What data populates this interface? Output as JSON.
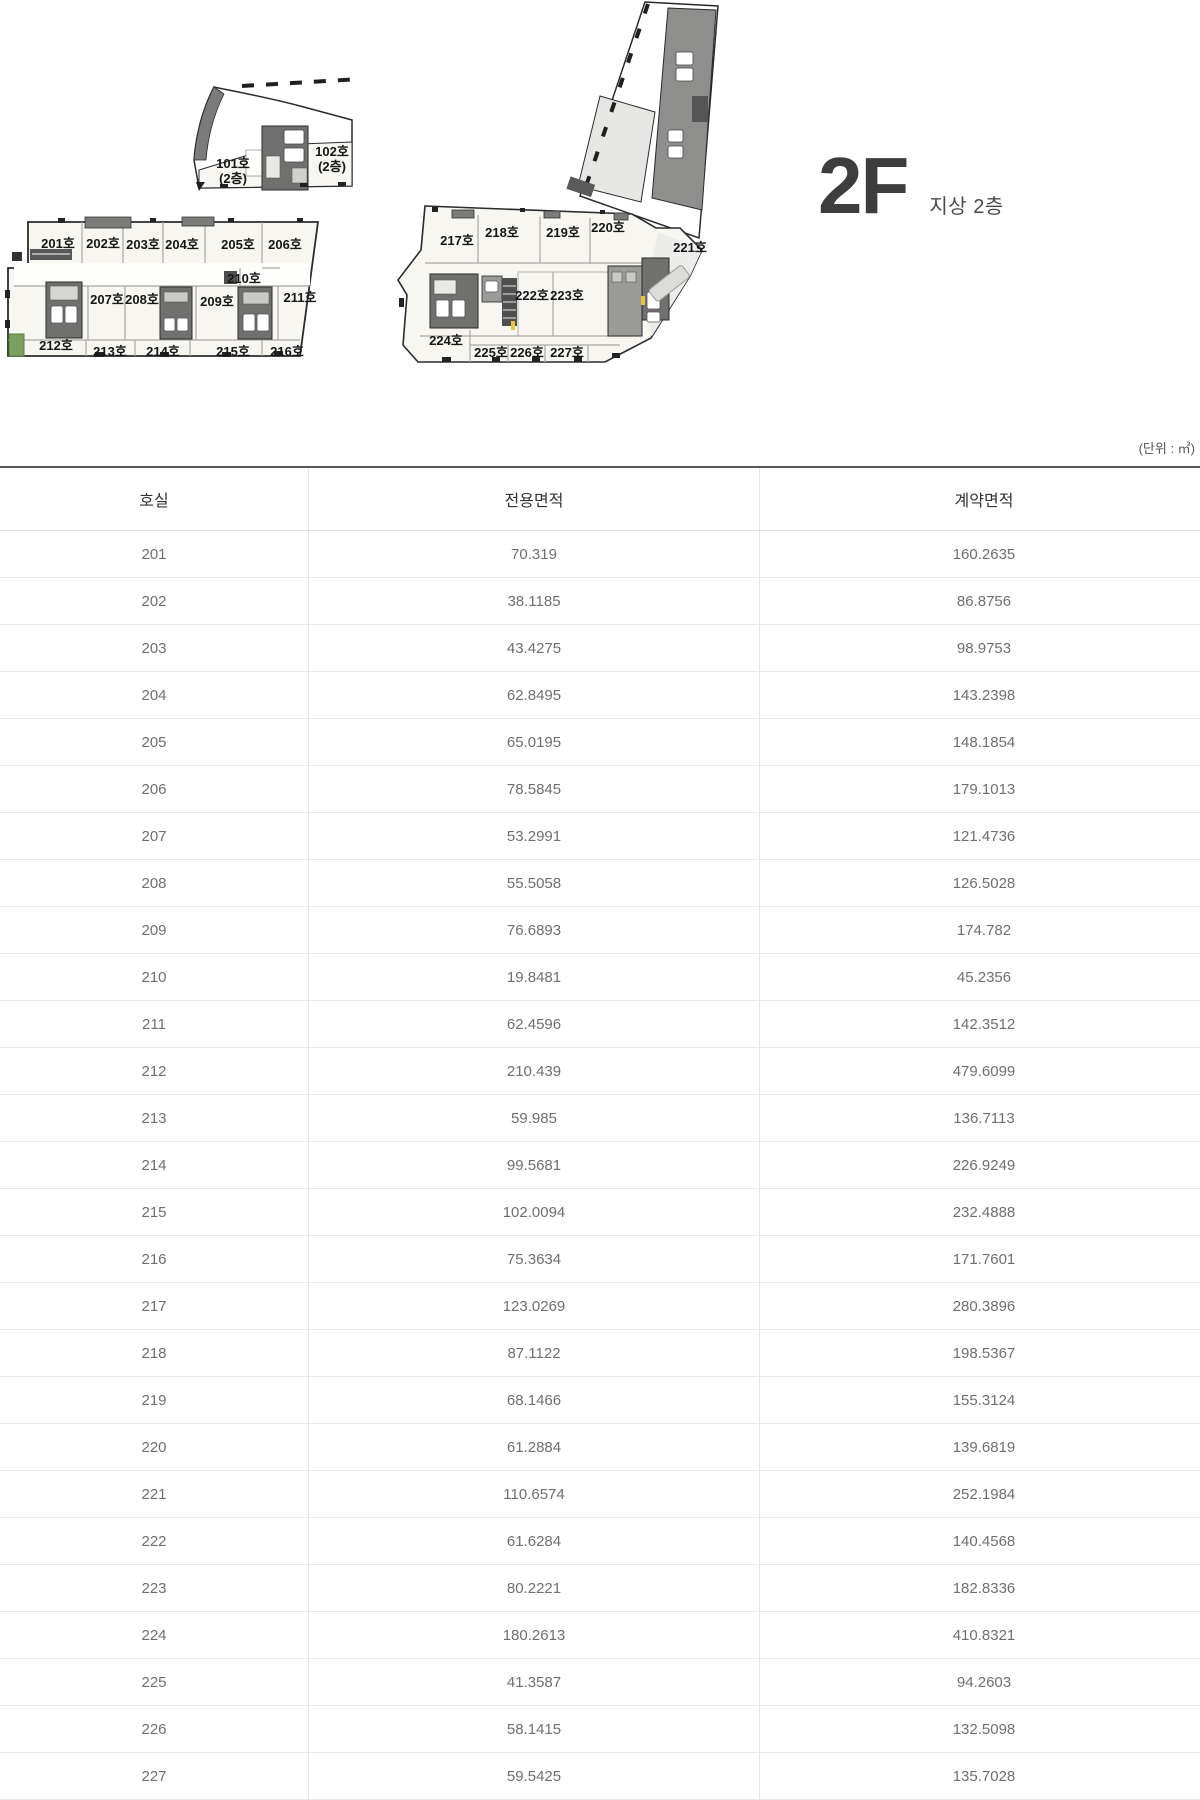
{
  "title": {
    "floor": "2F",
    "floor_desc": "지상 2층"
  },
  "unit_note": "(단위 : ㎡)",
  "plans": {
    "small_wing": {
      "labels": [
        {
          "text": "101호",
          "x": 233,
          "y": 168
        },
        {
          "text": "(2층)",
          "x": 233,
          "y": 183
        },
        {
          "text": "102호",
          "x": 332,
          "y": 156
        },
        {
          "text": "(2층)",
          "x": 332,
          "y": 171
        }
      ]
    },
    "left_wing": {
      "labels": [
        {
          "text": "201호",
          "x": 58,
          "y": 248
        },
        {
          "text": "202호",
          "x": 103,
          "y": 248
        },
        {
          "text": "203호",
          "x": 143,
          "y": 249
        },
        {
          "text": "204호",
          "x": 182,
          "y": 249
        },
        {
          "text": "205호",
          "x": 238,
          "y": 249
        },
        {
          "text": "206호",
          "x": 285,
          "y": 249
        },
        {
          "text": "207호",
          "x": 107,
          "y": 304
        },
        {
          "text": "208호",
          "x": 142,
          "y": 304
        },
        {
          "text": "209호",
          "x": 217,
          "y": 306
        },
        {
          "text": "210호",
          "x": 244,
          "y": 283
        },
        {
          "text": "211호",
          "x": 300,
          "y": 302
        },
        {
          "text": "212호",
          "x": 56,
          "y": 350
        },
        {
          "text": "213호",
          "x": 110,
          "y": 356
        },
        {
          "text": "214호",
          "x": 163,
          "y": 356
        },
        {
          "text": "215호",
          "x": 233,
          "y": 356
        },
        {
          "text": "216호",
          "x": 287,
          "y": 356
        }
      ]
    },
    "right_wing": {
      "labels": [
        {
          "text": "217호",
          "x": 457,
          "y": 245
        },
        {
          "text": "218호",
          "x": 502,
          "y": 237
        },
        {
          "text": "219호",
          "x": 563,
          "y": 237
        },
        {
          "text": "220호",
          "x": 608,
          "y": 232
        },
        {
          "text": "221호",
          "x": 690,
          "y": 252
        },
        {
          "text": "222호",
          "x": 532,
          "y": 300
        },
        {
          "text": "223호",
          "x": 567,
          "y": 300
        },
        {
          "text": "224호",
          "x": 446,
          "y": 345
        },
        {
          "text": "225호",
          "x": 491,
          "y": 357
        },
        {
          "text": "226호",
          "x": 527,
          "y": 357
        },
        {
          "text": "227호",
          "x": 567,
          "y": 357
        }
      ]
    }
  },
  "table": {
    "headers": [
      "호실",
      "전용면적",
      "계약면적"
    ],
    "rows": [
      [
        "201",
        "70.319",
        "160.2635"
      ],
      [
        "202",
        "38.1185",
        "86.8756"
      ],
      [
        "203",
        "43.4275",
        "98.9753"
      ],
      [
        "204",
        "62.8495",
        "143.2398"
      ],
      [
        "205",
        "65.0195",
        "148.1854"
      ],
      [
        "206",
        "78.5845",
        "179.1013"
      ],
      [
        "207",
        "53.2991",
        "121.4736"
      ],
      [
        "208",
        "55.5058",
        "126.5028"
      ],
      [
        "209",
        "76.6893",
        "174.782"
      ],
      [
        "210",
        "19.8481",
        "45.2356"
      ],
      [
        "211",
        "62.4596",
        "142.3512"
      ],
      [
        "212",
        "210.439",
        "479.6099"
      ],
      [
        "213",
        "59.985",
        "136.7113"
      ],
      [
        "214",
        "99.5681",
        "226.9249"
      ],
      [
        "215",
        "102.0094",
        "232.4888"
      ],
      [
        "216",
        "75.3634",
        "171.7601"
      ],
      [
        "217",
        "123.0269",
        "280.3896"
      ],
      [
        "218",
        "87.1122",
        "198.5367"
      ],
      [
        "219",
        "68.1466",
        "155.3124"
      ],
      [
        "220",
        "61.2884",
        "139.6819"
      ],
      [
        "221",
        "110.6574",
        "252.1984"
      ],
      [
        "222",
        "61.6284",
        "140.4568"
      ],
      [
        "223",
        "80.2221",
        "182.8336"
      ],
      [
        "224",
        "180.2613",
        "410.8321"
      ],
      [
        "225",
        "41.3587",
        "94.2603"
      ],
      [
        "226",
        "58.1415",
        "132.5098"
      ],
      [
        "227",
        "59.5425",
        "135.7028"
      ]
    ]
  },
  "colors": {
    "table_top_border": "#55595c",
    "row_divider": "#e9e9e9",
    "cell_text": "#6f6f6f",
    "header_text": "#333333",
    "plan_outline": "#2b2b2b",
    "plan_room": "#f7f6f1",
    "plan_core_dark": "#70706e",
    "plan_core_mid": "#9a9a98",
    "plan_green": "#79a05c",
    "plan_yellow": "#e6c63e"
  }
}
